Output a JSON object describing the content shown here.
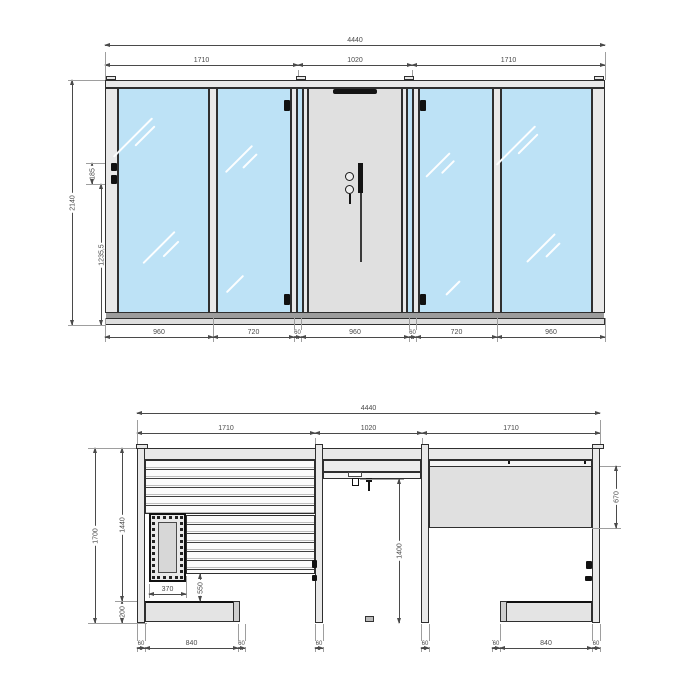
{
  "drawing": {
    "front_view": {
      "overall_width": "4440",
      "section_widths": [
        "1710",
        "1020",
        "1710"
      ],
      "overall_height": "2140",
      "hinge_offset": "185",
      "handle_height": "1235,5",
      "panel_widths": [
        "960",
        "720",
        "60",
        "960",
        "60",
        "720",
        "960"
      ]
    },
    "side_view": {
      "overall_width": "4440",
      "section_widths": [
        "1710",
        "1020",
        "1710"
      ],
      "overall_height": "1700",
      "interior_height": "1440",
      "plinth_height": "200",
      "heater_width": "370",
      "bench_height": "550",
      "opening_height": "1400",
      "transom_height": "670",
      "wall_post_widths": [
        "60",
        "60"
      ],
      "left_bench_segments": [
        "60",
        "840",
        "60"
      ],
      "right_bench_segments": [
        "60",
        "840",
        "60"
      ]
    }
  }
}
